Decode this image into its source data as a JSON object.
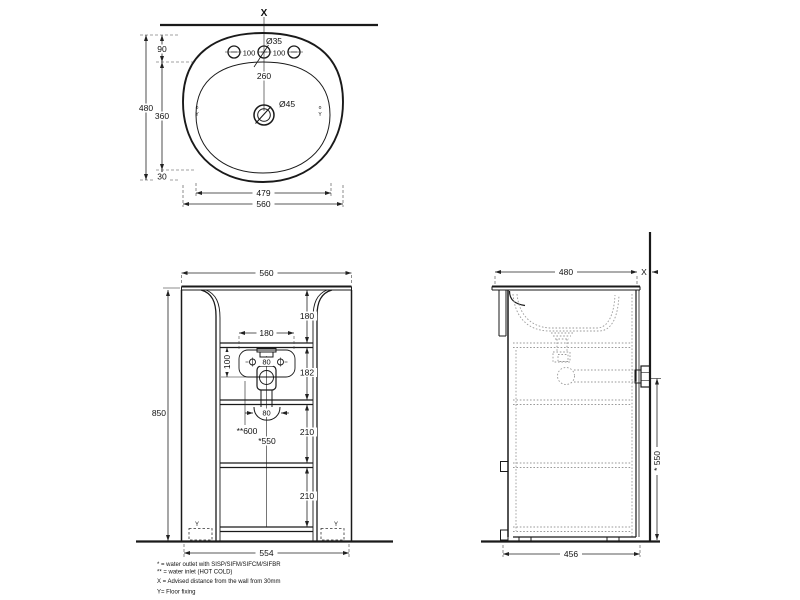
{
  "top_view": {
    "wall_marker": "X",
    "dim_overall_width": "560",
    "dim_basin_width": "479",
    "dim_overall_depth": "480",
    "dim_rim_to_holes": "90",
    "dim_basin_depth": "360",
    "dim_front_margin": "30",
    "dim_hole_spacing_left": "100",
    "dim_hole_spacing_right": "100",
    "label_hole_diameter": "Ø35",
    "dim_holes_to_drain": "260",
    "label_drain_diameter": "Ø45",
    "fixing_o_left": "o",
    "fixing_y_left": "Y",
    "fixing_o_right": "o",
    "fixing_y_right": "Y"
  },
  "front_view": {
    "dim_width": "560",
    "dim_height": "850",
    "dim_top_to_shelf": "180",
    "dim_recess_width": "180",
    "dim_inlet_spacing": "80",
    "dim_inlet_drop": "100",
    "dim_shelf_gap_1": "182",
    "dim_trap_width": "80",
    "dim_shelf_gap_2": "210",
    "dim_shelf_gap_3": "210",
    "label_inlet_height": "**600",
    "label_outlet_height": "*550",
    "dim_base_width": "554",
    "floor_marker_left": "Y",
    "floor_marker_right": "Y"
  },
  "side_view": {
    "dim_depth": "480",
    "wall_marker": "X",
    "dim_outlet_height": "* 550",
    "dim_base_depth": "456"
  },
  "footnotes": {
    "line1": "* = water outlet with SISP/SIFM/SIFCM/SIFBR",
    "line2": "** = water inlet (HOT COLD)",
    "line3": "X = Advised distance from the wall from 30mm",
    "line4": "Y= Floor fixing"
  }
}
